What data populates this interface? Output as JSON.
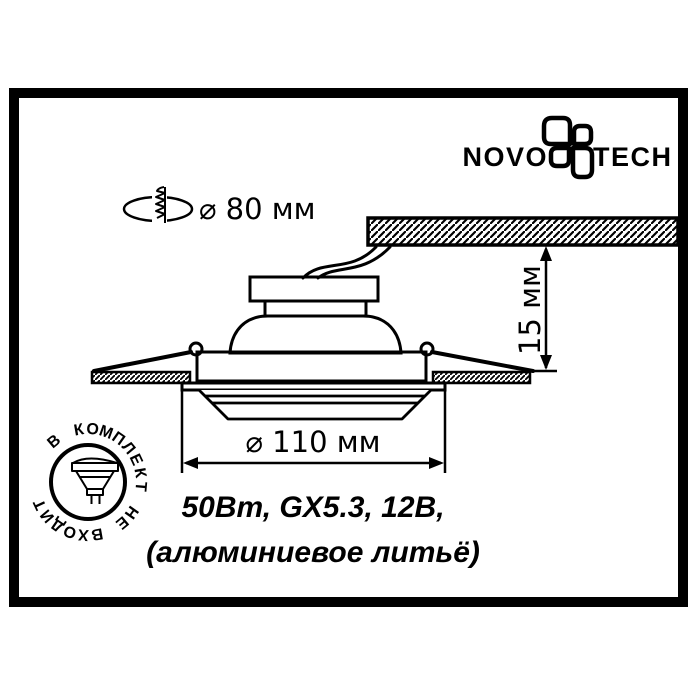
{
  "brand": {
    "name_left": "NOVO",
    "name_right": "TECH"
  },
  "dimensions": {
    "cutout": "⌀ 80 мм",
    "depth": "15 мм",
    "diameter": "⌀ 110 мм"
  },
  "specs": {
    "line1": "50Вт, GX5.3, 12В,",
    "line2": "(алюминиевое литьё)"
  },
  "stamp": {
    "ring_text": "В КОМПЛЕКТ НЕ ВХОДИТ"
  },
  "icons": {
    "logo_icon": "novotech-pinwheel",
    "cutout_icon": "screw-through-hole",
    "stamp_icon": "mr16-lamp"
  },
  "colors": {
    "ink": "#000000",
    "background": "#ffffff"
  }
}
